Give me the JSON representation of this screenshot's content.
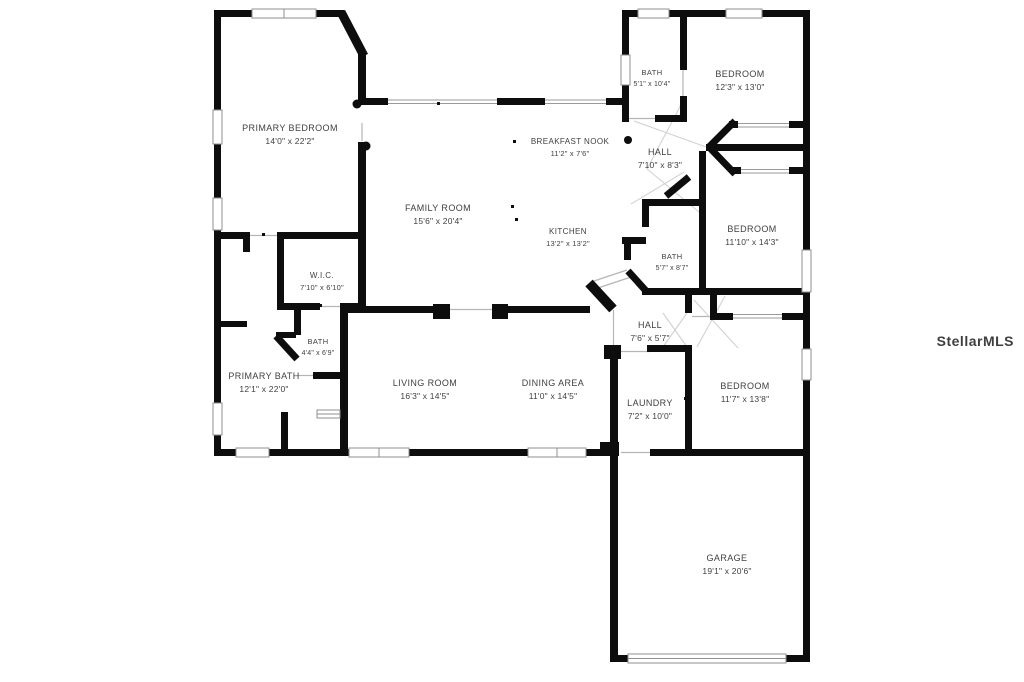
{
  "plan": {
    "watermark": "StellarMLS",
    "rooms": [
      {
        "id": "primary-bedroom",
        "name": "PRIMARY BEDROOM",
        "dims": "14'0\" x 22'2\""
      },
      {
        "id": "family-room",
        "name": "FAMILY ROOM",
        "dims": "15'6\" x 20'4\""
      },
      {
        "id": "breakfast-nook",
        "name": "BREAKFAST NOOK",
        "dims": "11'2\" x 7'6\""
      },
      {
        "id": "kitchen",
        "name": "KITCHEN",
        "dims": "13'2\" x 13'2\""
      },
      {
        "id": "bath-upper",
        "name": "BATH",
        "dims": "5'1\" x 10'4\""
      },
      {
        "id": "bedroom-ne",
        "name": "BEDROOM",
        "dims": "12'3\" x 13'0\""
      },
      {
        "id": "hall-upper",
        "name": "HALL",
        "dims": "7'10\" x 8'3\""
      },
      {
        "id": "bedroom-e",
        "name": "BEDROOM",
        "dims": "11'10\" x 14'3\""
      },
      {
        "id": "bath-middle",
        "name": "BATH",
        "dims": "5'7\" x 8'7\""
      },
      {
        "id": "wic",
        "name": "W.I.C.",
        "dims": "7'10\" x 6'10\""
      },
      {
        "id": "bath-small",
        "name": "BATH",
        "dims": "4'4\" x 6'9\""
      },
      {
        "id": "primary-bath",
        "name": "PRIMARY BATH",
        "dims": "12'1\" x 22'0\""
      },
      {
        "id": "living-room",
        "name": "LIVING ROOM",
        "dims": "16'3\" x 14'5\""
      },
      {
        "id": "dining-area",
        "name": "DINING AREA",
        "dims": "11'0\" x 14'5\""
      },
      {
        "id": "hall-lower",
        "name": "HALL",
        "dims": "7'6\" x 5'7\""
      },
      {
        "id": "laundry",
        "name": "LAUNDRY",
        "dims": "7'2\" x 10'0\""
      },
      {
        "id": "bedroom-se",
        "name": "BEDROOM",
        "dims": "11'7\" x 13'8\""
      },
      {
        "id": "garage",
        "name": "GARAGE",
        "dims": "19'1\" x 20'6\""
      }
    ],
    "colors": {
      "wall": "#0d0d0d",
      "label": "#3f3f3f",
      "opening_line": "#b5b5b5",
      "window_border": "#8f8f8f",
      "watermark": "#ebebeb"
    }
  }
}
